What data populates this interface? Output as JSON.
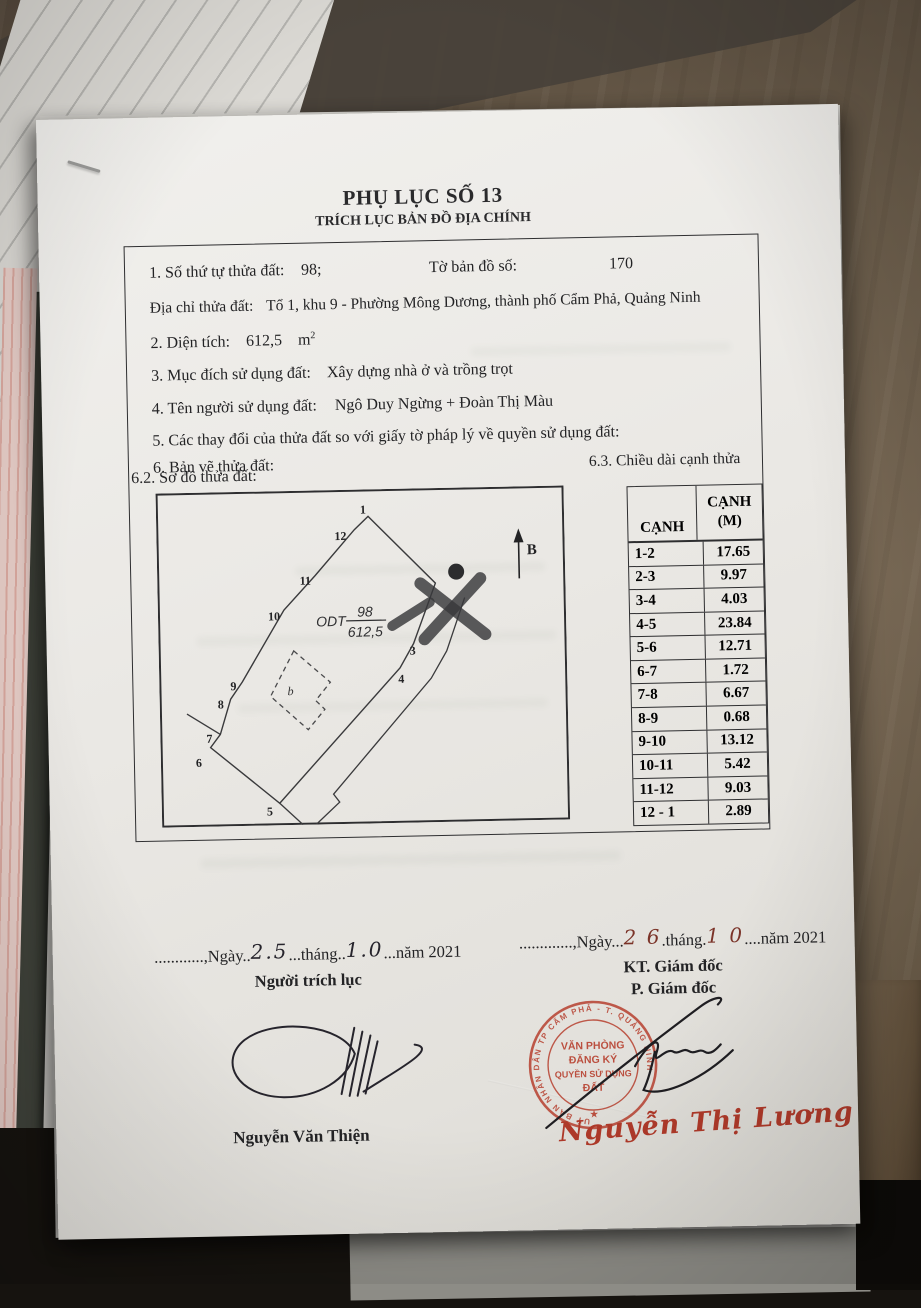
{
  "page": {
    "title": "PHỤ LỤC SỐ 13",
    "subtitle": "TRÍCH LỤC BẢN ĐỒ ĐỊA CHÍNH"
  },
  "fields": {
    "item1_label": "1. Số thứ tự thửa đất:",
    "item1_value": "98;",
    "sheet_label": "Tờ bản đồ số:",
    "sheet_value": "170",
    "address_label": "Địa chỉ thửa đất:",
    "address_value": "Tổ 1, khu 9 - Phường Mông Dương, thành phố Cẩm Phả, Quảng Ninh",
    "area_label": "2. Diện tích:",
    "area_value": "612,5",
    "area_unit": "m",
    "area_sup": "2",
    "purpose_label": "3. Mục đích sử dụng đất:",
    "purpose_value": "Xây dựng nhà ở và trồng trọt",
    "owner_label": "4. Tên người sử dụng đất:",
    "owner_value": "Ngô Duy Ngừng + Đoàn Thị Màu",
    "changes_label": "5. Các thay đổi của thửa đất so với giấy tờ pháp lý về quyền sử dụng đất:",
    "drawing_label": "6. Bản vẽ thửa đất:",
    "sketch_label": "6.2. Sơ đồ thửa đất:",
    "edges_label": "6.3. Chiều dài cạnh thửa"
  },
  "map": {
    "parcel_code": "ODT",
    "parcel_number": "98",
    "parcel_area": "612,5",
    "building_label": "b",
    "north_label": "B",
    "vertex_labels": [
      "1",
      "12",
      "11",
      "10",
      "9",
      "8",
      "7",
      "6",
      "5",
      "4",
      "3"
    ]
  },
  "table": {
    "col1_header": "CẠNH",
    "col2_header_line1": "CẠNH",
    "col2_header_line2": "(M)",
    "rows": [
      {
        "edge": "1-2",
        "m": "17.65"
      },
      {
        "edge": "2-3",
        "m": "9.97"
      },
      {
        "edge": "3-4",
        "m": "4.03"
      },
      {
        "edge": "4-5",
        "m": "23.84"
      },
      {
        "edge": "5-6",
        "m": "12.71"
      },
      {
        "edge": "6-7",
        "m": "1.72"
      },
      {
        "edge": "7-8",
        "m": "6.67"
      },
      {
        "edge": "8-9",
        "m": "0.68"
      },
      {
        "edge": "9-10",
        "m": "13.12"
      },
      {
        "edge": "10-11",
        "m": "5.42"
      },
      {
        "edge": "11-12",
        "m": "9.03"
      },
      {
        "edge": "12 - 1",
        "m": "2.89"
      }
    ]
  },
  "footer": {
    "left": {
      "p1": "............,Ngày..",
      "day": "2.5",
      "p2": "...tháng..",
      "month": "1.0",
      "p3": "...năm 2021",
      "role": "Người trích lục",
      "name": "Nguyễn Văn Thiện"
    },
    "right": {
      "p1": ".............,Ngày...",
      "day": "2 6",
      "p2": ".tháng.",
      "month": "1 0",
      "p3": "....năm 2021",
      "role1": "KT. Giám đốc",
      "role2": "P. Giám đốc",
      "name": "Nguyễn Thị Lương"
    }
  },
  "stamp": {
    "line1": "VĂN PHÒNG",
    "line2": "ĐĂNG KÝ",
    "line3": "QUYỀN SỬ DỤNG",
    "line4": "ĐẤT",
    "ring": "UỶ BAN NHÂN DÂN TP CẨM PHẢ - T. QUẢNG NINH",
    "star": "★"
  },
  "colors": {
    "stamp_red": "#b7402f",
    "signature_ink": "#26242c",
    "document_ink": "#232325"
  }
}
